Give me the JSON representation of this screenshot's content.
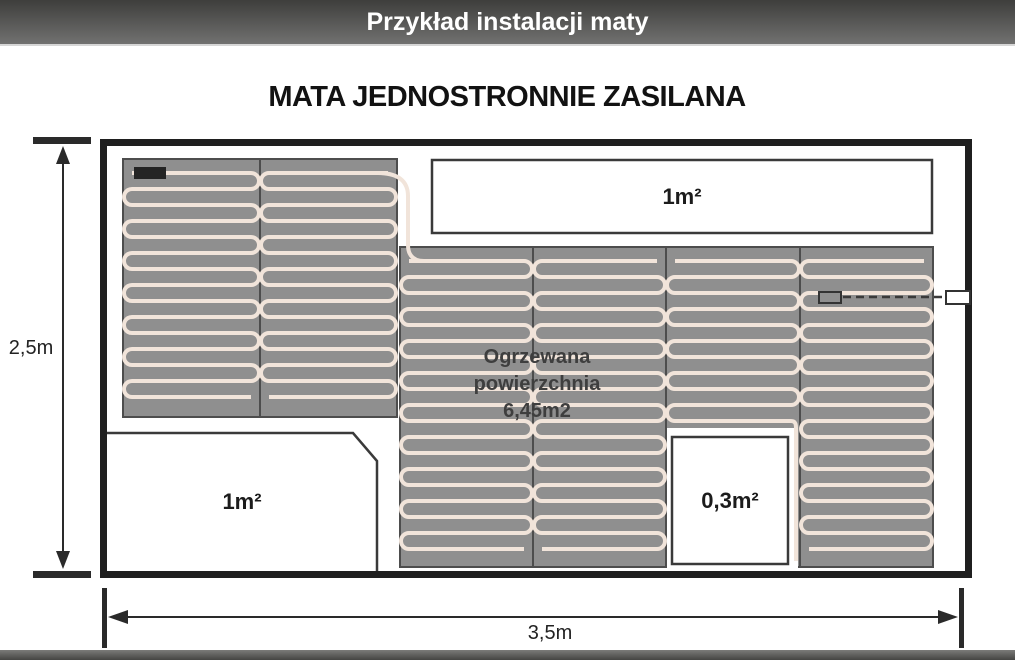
{
  "header": {
    "title": "Przykład instalacji maty"
  },
  "diagram": {
    "title": "MATA JEDNOSTRONNIE ZASILANA",
    "heated_area": {
      "line1": "Ogrzewana",
      "line2": "powierzchnia",
      "line3": "6,45m2"
    },
    "labels": {
      "top_gap": "1m²",
      "bottom_left_gap": "1m²",
      "small_gap": "0,3m²"
    },
    "dimensions": {
      "height": "2,5m",
      "width": "3,5m"
    }
  },
  "colors": {
    "header_gradient_top": "#3e3e3c",
    "header_gradient_bottom": "#717170",
    "wall": "#1f1f1f",
    "mat_fill": "#8f8f8f",
    "mat_border": "#4d4d4d",
    "cable": "#f1e4da",
    "thin_line": "#3a3a3a",
    "connector": "#242424",
    "text": "#1c1c1c"
  }
}
